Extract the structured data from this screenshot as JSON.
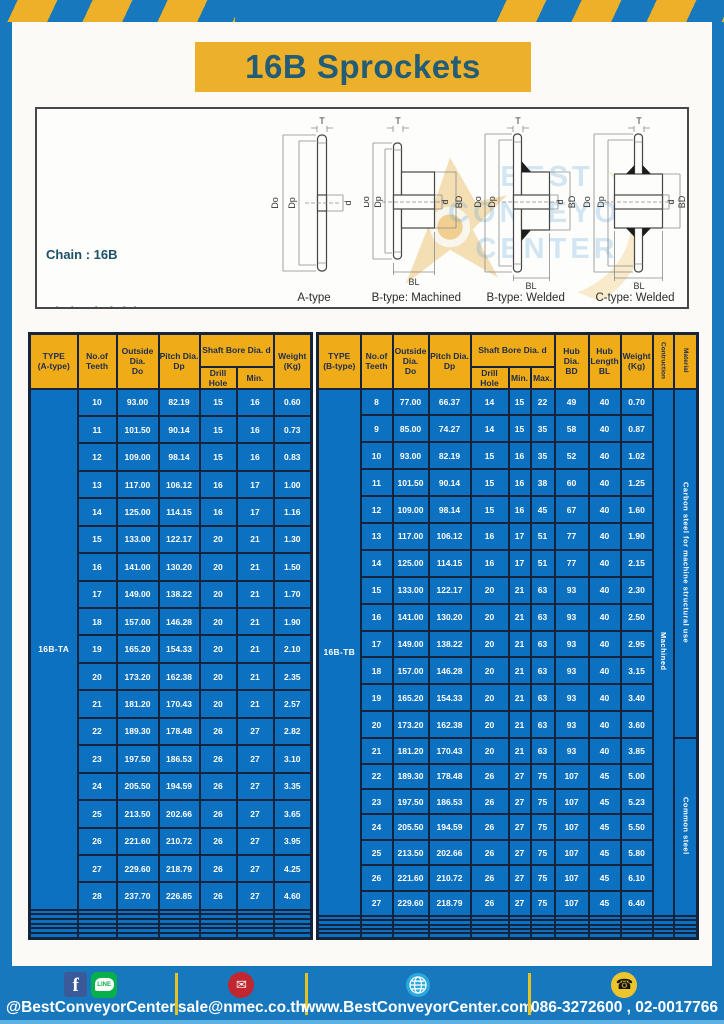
{
  "title": "16B Sprockets",
  "specs": {
    "lines": [
      "Chain : 16B",
      "Chain Pitch (P) : 25.4",
      "Roller Link Inside Width (W) : 17.02",
      "Roller Diameter (Dr) : 15.88",
      "Teeth Width (T) : 16.2"
    ]
  },
  "watermark": {
    "lines": [
      "BEST",
      "CONVEYOR",
      "CENTER"
    ]
  },
  "diagrams": [
    {
      "label": "A-type",
      "dims": [
        "T",
        "Do",
        "Dp",
        "d"
      ]
    },
    {
      "label": "B-type: Machined",
      "dims": [
        "T",
        "Do",
        "Dp",
        "d",
        "BD",
        "BL"
      ]
    },
    {
      "label": "B-type: Welded",
      "dims": [
        "T",
        "Do",
        "Dp",
        "d",
        "BD",
        "BL"
      ]
    },
    {
      "label": "C-type: Welded",
      "dims": [
        "T",
        "Do",
        "Dp",
        "d",
        "BD",
        "BL"
      ]
    }
  ],
  "table_a": {
    "headers": [
      "TYPE\n(A-type)",
      "No.of\nTeeth",
      "Outside\nDia.\nDo",
      "Pitch Dia.\nDp",
      "Shaft Bore Dia. d",
      "Drill Hole",
      "Min.",
      "Weight\n(Kg)"
    ],
    "type_label": "16B-TA",
    "cols": 7,
    "empty_rows": 6,
    "merged": [],
    "rows": [
      [
        "10",
        "93.00",
        "82.19",
        "15",
        "16",
        "0.60"
      ],
      [
        "11",
        "101.50",
        "90.14",
        "15",
        "16",
        "0.73"
      ],
      [
        "12",
        "109.00",
        "98.14",
        "15",
        "16",
        "0.83"
      ],
      [
        "13",
        "117.00",
        "106.12",
        "16",
        "17",
        "1.00"
      ],
      [
        "14",
        "125.00",
        "114.15",
        "16",
        "17",
        "1.16"
      ],
      [
        "15",
        "133.00",
        "122.17",
        "20",
        "21",
        "1.30"
      ],
      [
        "16",
        "141.00",
        "130.20",
        "20",
        "21",
        "1.50"
      ],
      [
        "17",
        "149.00",
        "138.22",
        "20",
        "21",
        "1.70"
      ],
      [
        "18",
        "157.00",
        "146.28",
        "20",
        "21",
        "1.90"
      ],
      [
        "19",
        "165.20",
        "154.33",
        "20",
        "21",
        "2.10"
      ],
      [
        "20",
        "173.20",
        "162.38",
        "20",
        "21",
        "2.35"
      ],
      [
        "21",
        "181.20",
        "170.43",
        "20",
        "21",
        "2.57"
      ],
      [
        "22",
        "189.30",
        "178.48",
        "26",
        "27",
        "2.82"
      ],
      [
        "23",
        "197.50",
        "186.53",
        "26",
        "27",
        "3.10"
      ],
      [
        "24",
        "205.50",
        "194.59",
        "26",
        "27",
        "3.35"
      ],
      [
        "25",
        "213.50",
        "202.66",
        "26",
        "27",
        "3.65"
      ],
      [
        "26",
        "221.60",
        "210.72",
        "26",
        "27",
        "3.95"
      ],
      [
        "27",
        "229.60",
        "218.79",
        "26",
        "27",
        "4.25"
      ],
      [
        "28",
        "237.70",
        "226.85",
        "26",
        "27",
        "4.60"
      ]
    ]
  },
  "table_b": {
    "headers": [
      "TYPE\n(B-type)",
      "No.of\nTeeth",
      "Outside\nDia.\nDo",
      "Pitch Dia.\nDp",
      "Shaft Bore Dia. d",
      "Drill Hole",
      "Min.",
      "Max.",
      "Hub Dia.\nBD",
      "Hub\nLength\nBL",
      "Weight\n(Kg)",
      "Contruction",
      "Material"
    ],
    "type_label": "16B-TB",
    "cols": 12,
    "empty_rows": 5,
    "merged": [
      {
        "label": "Machined",
        "start": 0,
        "span": 20,
        "name": "construction-value"
      },
      {
        "label": "Carbon steel for machine structural use",
        "start": 0,
        "span": 13,
        "name": "material-value"
      },
      {
        "label": "Common steel",
        "start": 13,
        "span": 7,
        "name": "material-value"
      }
    ],
    "rows": [
      [
        "8",
        "77.00",
        "66.37",
        "14",
        "15",
        "22",
        "49",
        "40",
        "0.70"
      ],
      [
        "9",
        "85.00",
        "74.27",
        "14",
        "15",
        "35",
        "58",
        "40",
        "0.87"
      ],
      [
        "10",
        "93.00",
        "82.19",
        "15",
        "16",
        "35",
        "52",
        "40",
        "1.02"
      ],
      [
        "11",
        "101.50",
        "90.14",
        "15",
        "16",
        "38",
        "60",
        "40",
        "1.25"
      ],
      [
        "12",
        "109.00",
        "98.14",
        "15",
        "16",
        "45",
        "67",
        "40",
        "1.60"
      ],
      [
        "13",
        "117.00",
        "106.12",
        "16",
        "17",
        "51",
        "77",
        "40",
        "1.90"
      ],
      [
        "14",
        "125.00",
        "114.15",
        "16",
        "17",
        "51",
        "77",
        "40",
        "2.15"
      ],
      [
        "15",
        "133.00",
        "122.17",
        "20",
        "21",
        "63",
        "93",
        "40",
        "2.30"
      ],
      [
        "16",
        "141.00",
        "130.20",
        "20",
        "21",
        "63",
        "93",
        "40",
        "2.50"
      ],
      [
        "17",
        "149.00",
        "138.22",
        "20",
        "21",
        "63",
        "93",
        "40",
        "2.95"
      ],
      [
        "18",
        "157.00",
        "146.28",
        "20",
        "21",
        "63",
        "93",
        "40",
        "3.15"
      ],
      [
        "19",
        "165.20",
        "154.33",
        "20",
        "21",
        "63",
        "93",
        "40",
        "3.40"
      ],
      [
        "20",
        "173.20",
        "162.38",
        "20",
        "21",
        "63",
        "93",
        "40",
        "3.60"
      ],
      [
        "21",
        "181.20",
        "170.43",
        "20",
        "21",
        "63",
        "93",
        "40",
        "3.85"
      ],
      [
        "22",
        "189.30",
        "178.48",
        "26",
        "27",
        "75",
        "107",
        "45",
        "5.00"
      ],
      [
        "23",
        "197.50",
        "186.53",
        "26",
        "27",
        "75",
        "107",
        "45",
        "5.23"
      ],
      [
        "24",
        "205.50",
        "194.59",
        "26",
        "27",
        "75",
        "107",
        "45",
        "5.50"
      ],
      [
        "25",
        "213.50",
        "202.66",
        "26",
        "27",
        "75",
        "107",
        "45",
        "5.80"
      ],
      [
        "26",
        "221.60",
        "210.72",
        "26",
        "27",
        "75",
        "107",
        "45",
        "6.10"
      ],
      [
        "27",
        "229.60",
        "218.79",
        "26",
        "27",
        "75",
        "107",
        "45",
        "6.40"
      ]
    ]
  },
  "footer": {
    "social_handle": "@BestConveyorCenter",
    "line_label": "LINE",
    "fb_glyph": "f",
    "mail_glyph": "✉",
    "phone_glyph": "☎",
    "email": "sale@nmec.co.th",
    "website": "www.BestConveyorCenter.com",
    "phone": "086-3272600 , 02-0017766"
  },
  "colors": {
    "frame_blue": "#1878be",
    "banner_yellow": "#edb02b",
    "header_yellow": "#efac17",
    "cell_blue": "#0d71c1",
    "border_navy": "#16233d",
    "title_teal": "#235c76"
  }
}
